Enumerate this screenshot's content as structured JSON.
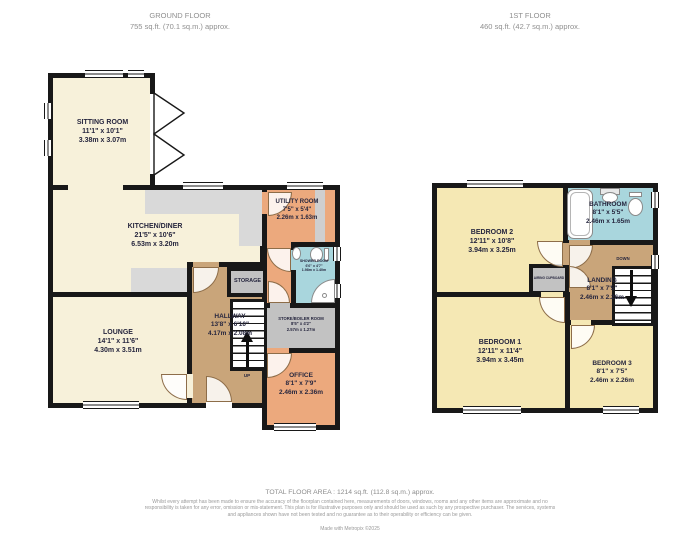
{
  "colors": {
    "wall": "#181818",
    "cream_room": "#f7f1da",
    "yellow_room": "#f5e8b4",
    "tan_hall": "#c9a57a",
    "orange_room": "#eca97d",
    "blue_bath": "#a9d6dd",
    "gray_store": "#c2c2c2",
    "gray_counter": "#d9d9d9"
  },
  "ground_floor": {
    "title": "GROUND FLOOR",
    "area": "755 sq.ft. (70.1 sq.m.) approx.",
    "rooms": {
      "sitting": {
        "name": "SITTING ROOM",
        "imperial": "11'1\" x 10'1\"",
        "metric": "3.38m x 3.07m"
      },
      "kitchen": {
        "name": "KITCHEN/DINER",
        "imperial": "21'5\" x 10'6\"",
        "metric": "6.53m x 3.20m"
      },
      "lounge": {
        "name": "LOUNGE",
        "imperial": "14'1\" x 11'6\"",
        "metric": "4.30m x 3.51m"
      },
      "hallway": {
        "name": "HALLWAY",
        "imperial": "13'8\" x 6'10\"",
        "metric": "4.17m x 2.08m"
      },
      "utility": {
        "name": "UTILITY ROOM",
        "imperial": "7'5\" x 5'4\"",
        "metric": "2.26m x 1.63m"
      },
      "shower": {
        "name": "SHOWER ROOM",
        "imperial": "6'6\" x 4'7\"",
        "metric": "1.98m x 1.40m"
      },
      "storage": {
        "name": "STORAGE"
      },
      "store_boiler": {
        "name": "STORE/BOILER ROOM",
        "imperial": "8'5\" x 4'2\"",
        "metric": "2.57m x 1.27m"
      },
      "office": {
        "name": "OFFICE",
        "imperial": "8'1\" x 7'9\"",
        "metric": "2.46m x 2.36m"
      }
    },
    "stairs_label": "UP"
  },
  "first_floor": {
    "title": "1ST FLOOR",
    "area": "460 sq.ft. (42.7 sq.m.) approx.",
    "rooms": {
      "bedroom2": {
        "name": "BEDROOM 2",
        "imperial": "12'11\" x 10'8\"",
        "metric": "3.94m x 3.25m"
      },
      "bathroom": {
        "name": "BATHROOM",
        "imperial": "8'1\" x 5'5\"",
        "metric": "2.46m x 1.65m"
      },
      "landing": {
        "name": "LANDING",
        "imperial": "8'1\" x 7'5\"",
        "metric": "2.46m x 2.26m"
      },
      "bedroom1": {
        "name": "BEDROOM 1",
        "imperial": "12'11\" x 11'4\"",
        "metric": "3.94m x 3.45m"
      },
      "bedroom3": {
        "name": "BEDROOM 3",
        "imperial": "8'1\" x 7'5\"",
        "metric": "2.46m x 2.26m"
      },
      "airing": {
        "name": "AIRING CUPBOARD"
      }
    },
    "stairs_label": "DOWN"
  },
  "footer": {
    "total_area": "TOTAL FLOOR AREA : 1214 sq.ft. (112.8 sq.m.) approx.",
    "disclaimer": "Whilst every attempt has been made to ensure the accuracy of the floorplan contained here, measurements of doors, windows, rooms and any other items are approximate and no responsibility is taken for any error, omission or mis-statement. This plan is for illustrative purposes only and should be used as such by any prospective purchaser. The services, systems and appliances shown have not been tested and no guarantee as to their operability or efficiency can be given.",
    "credit": "Made with Metropix ©2025"
  }
}
